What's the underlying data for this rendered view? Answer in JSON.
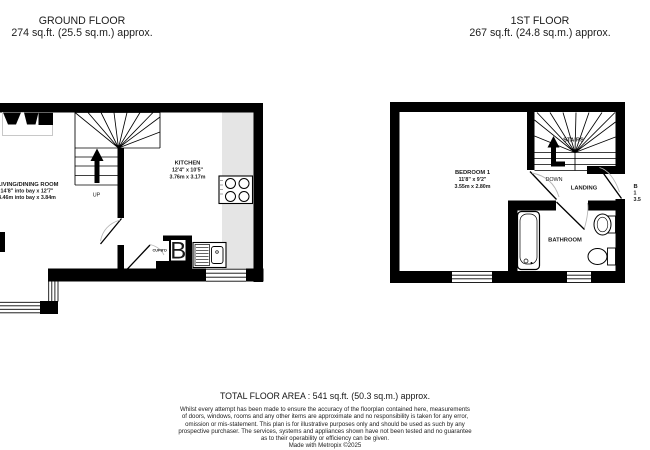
{
  "ground_floor": {
    "title": "GROUND FLOOR",
    "area": "274 sq.ft. (25.5 sq.m.) approx.",
    "stairs_direction": "UP",
    "rooms": {
      "living_dining": {
        "name": "LIVING/DINING ROOM",
        "dims_imperial": "14'8\" into bay x 12'7\"",
        "dims_metric": "4.46m into bay x 3.84m"
      },
      "kitchen": {
        "name": "KITCHEN",
        "dims_imperial": "12'4\" x 10'5\"",
        "dims_metric": "3.76m x 3.17m"
      },
      "cupboard": {
        "name": "CUPB'D",
        "boiler_symbol": "B"
      }
    }
  },
  "first_floor": {
    "title": "1ST FLOOR",
    "area": "267 sq.ft. (24.8 sq.m.) approx.",
    "stairs_direction": "DOWN",
    "rooms": {
      "bedroom1": {
        "name": "BEDROOM 1",
        "dims_imperial": "11'8\" x 9'2\"",
        "dims_metric": "3.55m x 2.80m"
      },
      "bathroom": {
        "name": "BATHROOM"
      },
      "landing": {
        "name": "LANDING"
      },
      "stairs": {
        "name": "STAIRS"
      },
      "bedroom2_clipped": {
        "line1": "B",
        "line2": "1",
        "line3": "3.5"
      }
    }
  },
  "footer": {
    "total_area": "TOTAL FLOOR AREA : 541 sq.ft. (50.3 sq.m.) approx.",
    "disclaimer_lines": [
      "Whilst every attempt has been made to ensure the accuracy of the floorplan contained here, measurements",
      "of doors, windows, rooms and any other items are approximate and no responsibility is taken for any error,",
      "omission or mis-statement. This plan is for illustrative purposes only and should be used as such by any",
      "prospective purchaser. The services, systems and appliances shown have not been tested and no guarantee",
      "as to their operability or efficiency can be given."
    ],
    "credit": "Made with Metropix ©2025"
  },
  "colors": {
    "wall": "#000000",
    "counter": "#e5e5e5",
    "door_arc": "#bbbbbb",
    "text": "#1a1a1a"
  }
}
